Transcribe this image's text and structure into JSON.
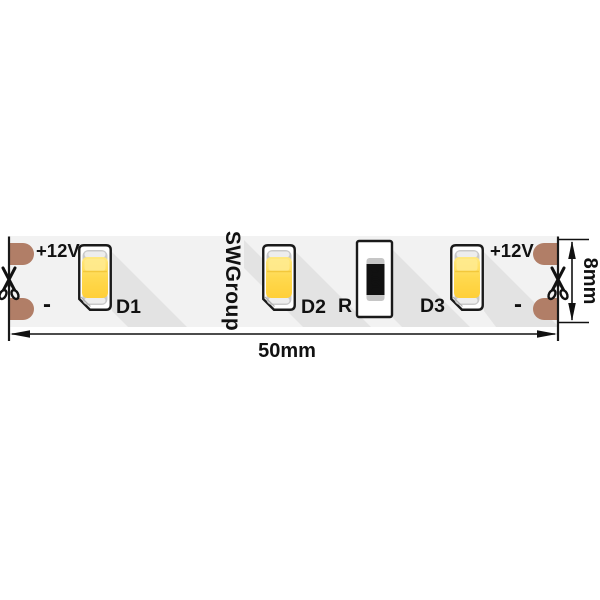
{
  "diagram": {
    "brand": {
      "text": "SWGroup",
      "color": "#E8A33C"
    },
    "strip": {
      "left_positive": "+12V",
      "left_negative": "-",
      "right_positive": "+12V",
      "right_negative": "-"
    },
    "components": {
      "led1": "D1",
      "led2": "D2",
      "led3": "D3",
      "resistor_label": "R",
      "resistor_code": "101"
    },
    "dimensions": {
      "length": "50mm",
      "height": "8mm"
    },
    "colors": {
      "pad": "#B17E67",
      "led_body": "#FFD94E",
      "strip_face": "#F2F2F2",
      "shadow": "#E3E3E3",
      "outline": "#1A1A1A",
      "resistor_body": "#111111"
    },
    "icons": {
      "cut_marks": "scissors-icon"
    }
  }
}
